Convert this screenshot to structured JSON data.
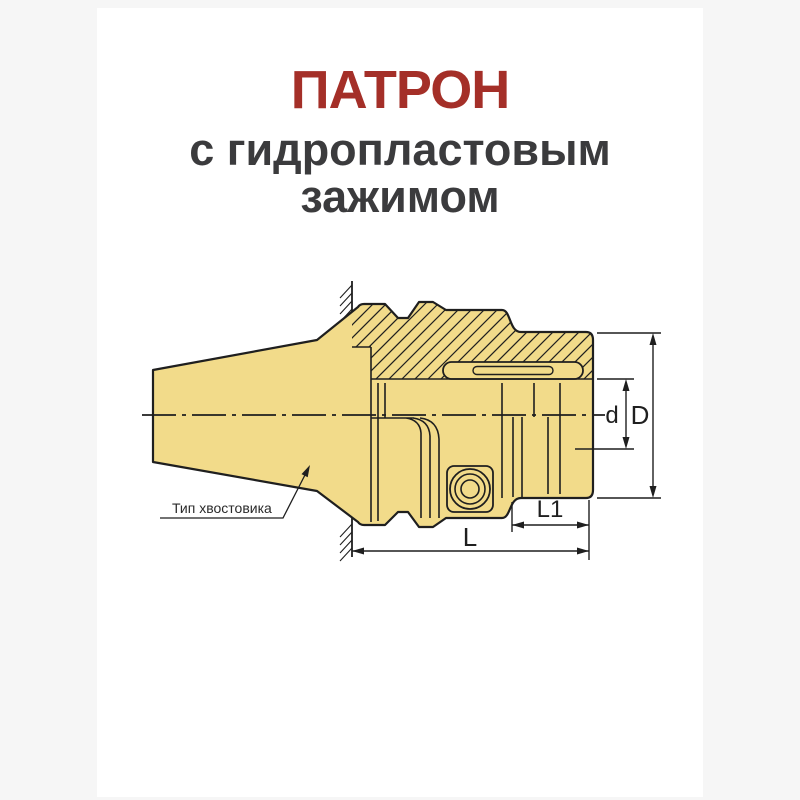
{
  "page": {
    "background_color": "#f6f6f6",
    "sheet_color": "#ffffff"
  },
  "header": {
    "title": "ПАТРОН",
    "title_color": "#a42f28",
    "subtitle_line1": "с гидропластовым",
    "subtitle_line2": "зажимом",
    "subtitle_color": "#3b3b3d"
  },
  "drawing": {
    "part_fill": "#f2db8a",
    "line_color": "#1f1f1f",
    "labels": {
      "shank_type": "Тип хвостовика",
      "dim_overall_diameter": "D",
      "dim_bore_diameter": "d",
      "dim_overall_length": "L",
      "dim_nose_length": "L1"
    }
  }
}
